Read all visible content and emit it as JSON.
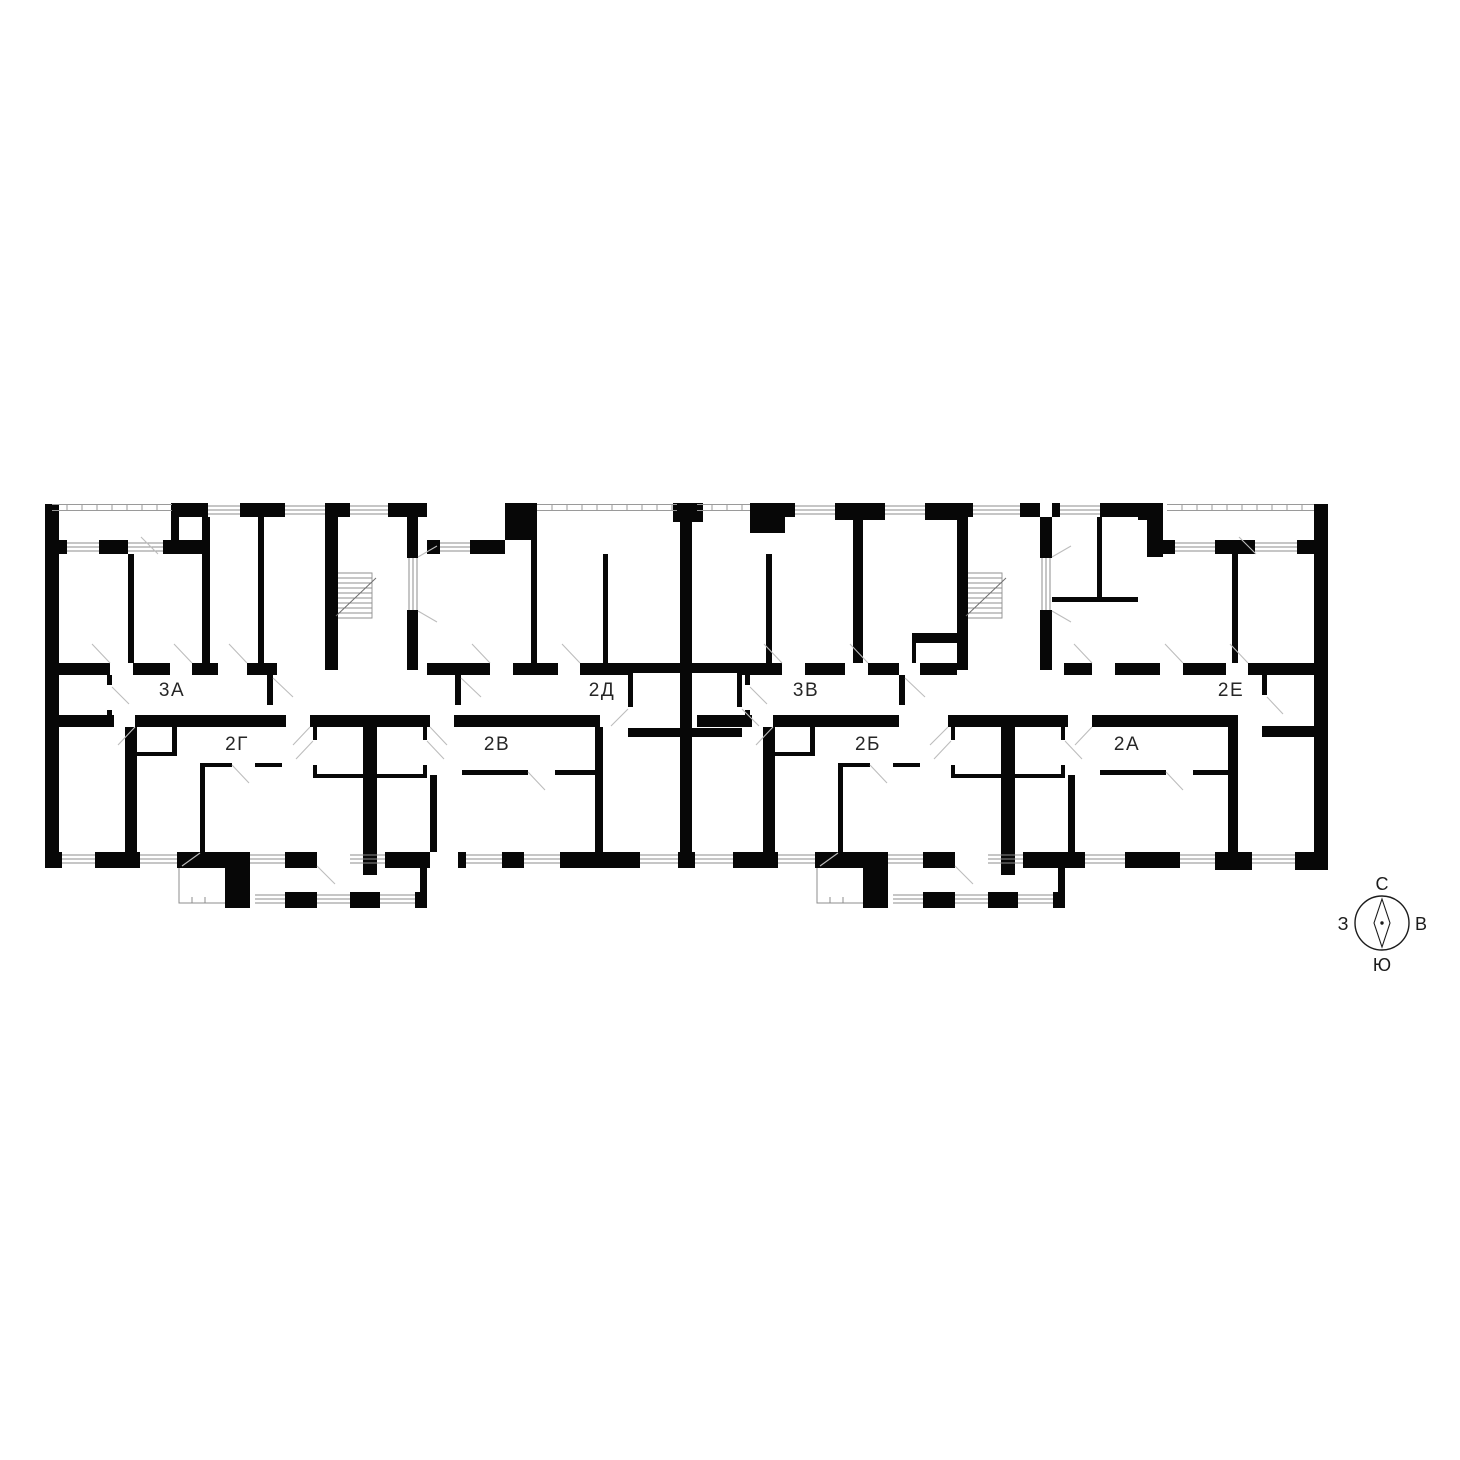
{
  "plan": {
    "title": "floor-plan",
    "apartment_labels": [
      {
        "id": "apt-3a",
        "text": "3А"
      },
      {
        "id": "apt-2g",
        "text": "2Г"
      },
      {
        "id": "apt-2v",
        "text": "2В"
      },
      {
        "id": "apt-2d",
        "text": "2Д"
      },
      {
        "id": "apt-3v",
        "text": "3В"
      },
      {
        "id": "apt-2b",
        "text": "2Б"
      },
      {
        "id": "apt-2a",
        "text": "2А"
      },
      {
        "id": "apt-2e",
        "text": "2Е"
      }
    ]
  },
  "compass": {
    "north": "С",
    "south": "Ю",
    "west": "З",
    "east": "В"
  },
  "colors": {
    "background": "#ffffff",
    "walls": "#070707",
    "window_lines": "#8c8c8c",
    "door_swings": "#bdbdbd",
    "labels": "#262626"
  }
}
